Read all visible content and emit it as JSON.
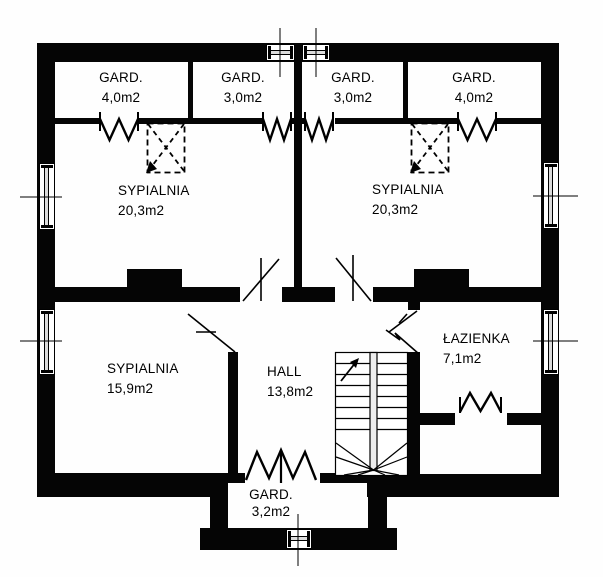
{
  "plan": {
    "colors": {
      "wall": "#050505",
      "floor": "#ffffff",
      "stair_stringer": "#ededed"
    },
    "rooms": [
      {
        "id": "gard-top-left",
        "name": "GARD.",
        "area": "4,0m2"
      },
      {
        "id": "gard-top-midleft",
        "name": "GARD.",
        "area": "3,0m2"
      },
      {
        "id": "gard-top-midright",
        "name": "GARD.",
        "area": "3,0m2"
      },
      {
        "id": "gard-top-right",
        "name": "GARD.",
        "area": "4,0m2"
      },
      {
        "id": "bedroom-left",
        "name": "SYPIALNIA",
        "area": "20,3m2"
      },
      {
        "id": "bedroom-right",
        "name": "SYPIALNIA",
        "area": "20,3m2"
      },
      {
        "id": "bedroom-bottom",
        "name": "SYPIALNIA",
        "area": "15,9m2"
      },
      {
        "id": "hall",
        "name": "HALL",
        "area": "13,8m2"
      },
      {
        "id": "bathroom",
        "name": "ŁAZIENKA",
        "area": "7,1m2"
      },
      {
        "id": "gard-bottom",
        "name": "GARD.",
        "area": "3,2m2"
      }
    ]
  }
}
